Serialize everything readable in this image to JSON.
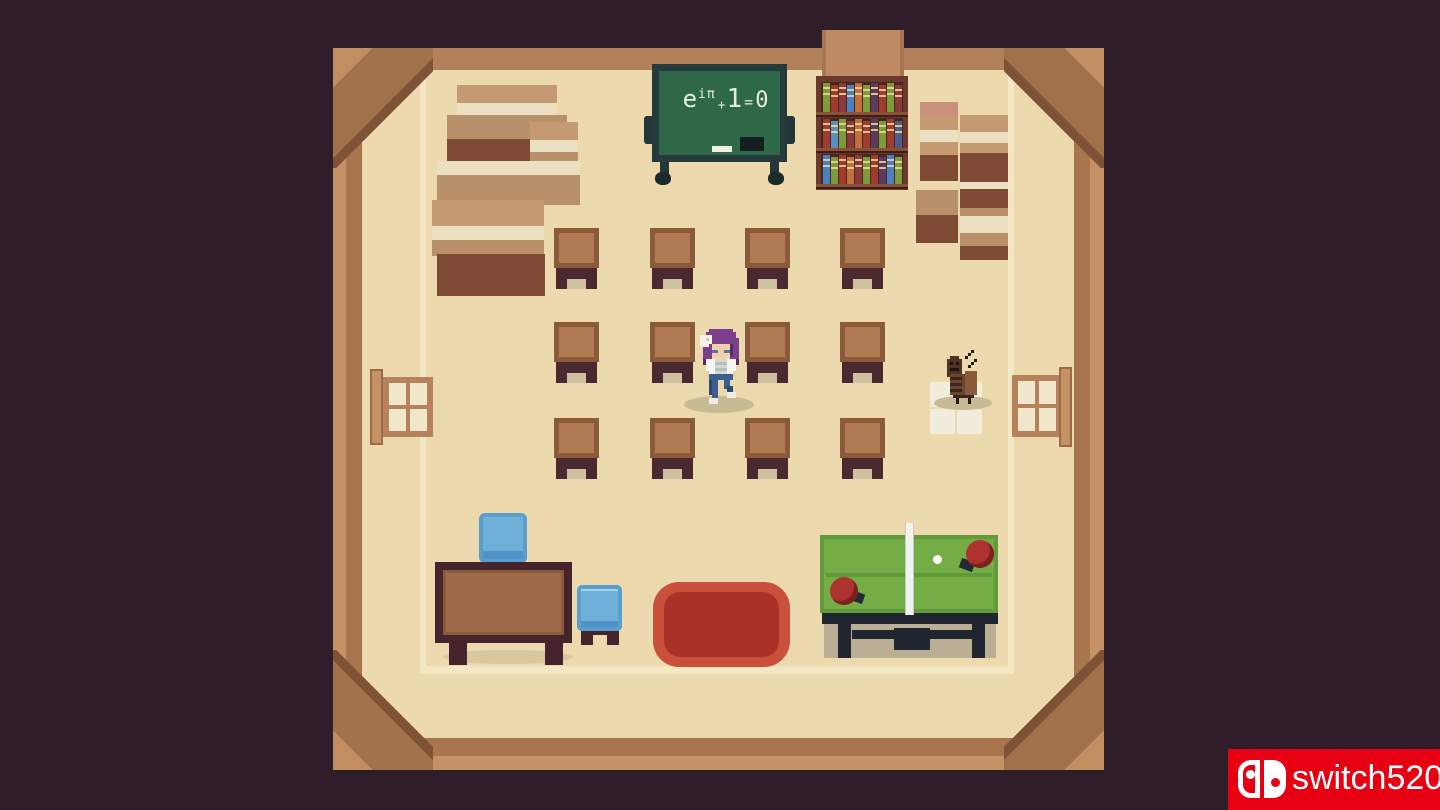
{
  "scene": {
    "name": "pixel-art classroom",
    "chalkboard": {
      "formula_reading": "e^iπ + 1 = 0",
      "base": "e",
      "exponent": "iπ",
      "plus": "+",
      "one": "1",
      "equals": "=",
      "zero": "0"
    },
    "desk_grid": {
      "rows": 3,
      "columns": 4
    },
    "objects": [
      "chalkboard",
      "bookshelf",
      "book-stacks",
      "student-desks",
      "player-character",
      "cockroach-npc",
      "floor-tiles",
      "teacher-desk",
      "blue-chair",
      "blue-chair",
      "red-rug",
      "ping-pong-table",
      "paddles",
      "ball",
      "window-left",
      "window-right"
    ]
  },
  "watermark": {
    "text": "switch520",
    "background_color": "#e60012"
  },
  "palette": {
    "background": "#2f1d2a",
    "floor_cream": "#ecd9ae",
    "frame_light_brown": "#c49265",
    "frame_dark_brown": "#a9754c",
    "desk_wood": "#b07a52",
    "desk_base": "#4a2a30",
    "chalkboard_green": "#2f6849",
    "chalkboard_frame": "#253a3a",
    "rug_red_outer": "#c9513c",
    "rug_red_inner": "#a93228",
    "table_tennis_green": "#74ac46",
    "chair_blue": "#6fb0d8",
    "character_hair_purple": "#7c3f8c",
    "jeans_blue": "#3a5f8e"
  }
}
